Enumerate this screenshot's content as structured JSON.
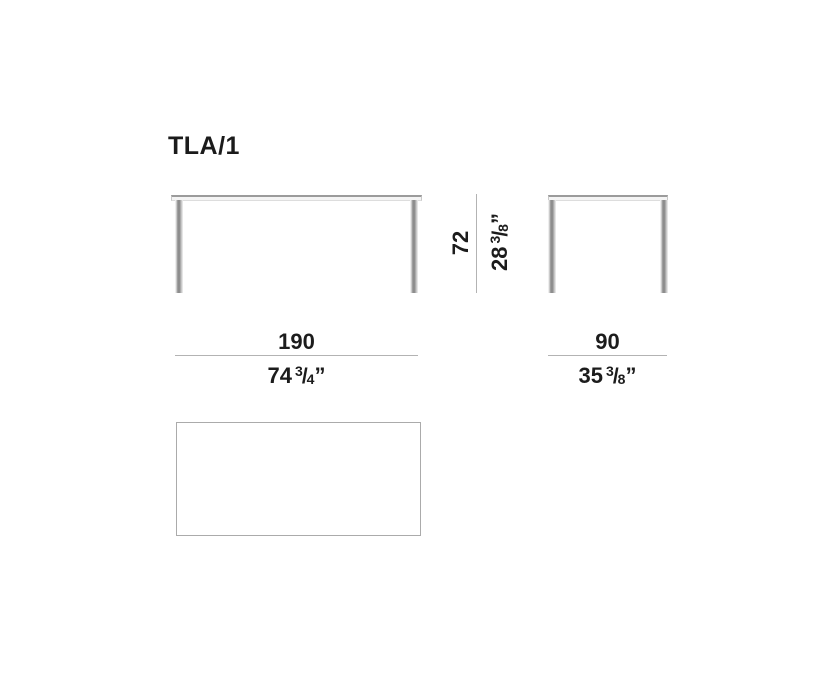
{
  "title": "TLA/1",
  "colors": {
    "text": "#1b1b1b",
    "dimension_line": "#b3b3b3",
    "leg_shadow": "#8d8d8d",
    "tabletop_edge": "#9b9b9b",
    "plan_border": "#ababab",
    "background": "#ffffff"
  },
  "dimensions": {
    "width": {
      "cm": "190",
      "in_whole": "74",
      "in_num": "3",
      "slash": "/",
      "in_den": "4",
      "quote": "”"
    },
    "depth": {
      "cm": "90",
      "in_whole": "35",
      "in_num": "3",
      "slash": "/",
      "in_den": "8",
      "quote": "”"
    },
    "height": {
      "cm": "72",
      "in_whole": "28",
      "in_num": "3",
      "slash": "/",
      "in_den": "8",
      "quote": "”"
    }
  }
}
